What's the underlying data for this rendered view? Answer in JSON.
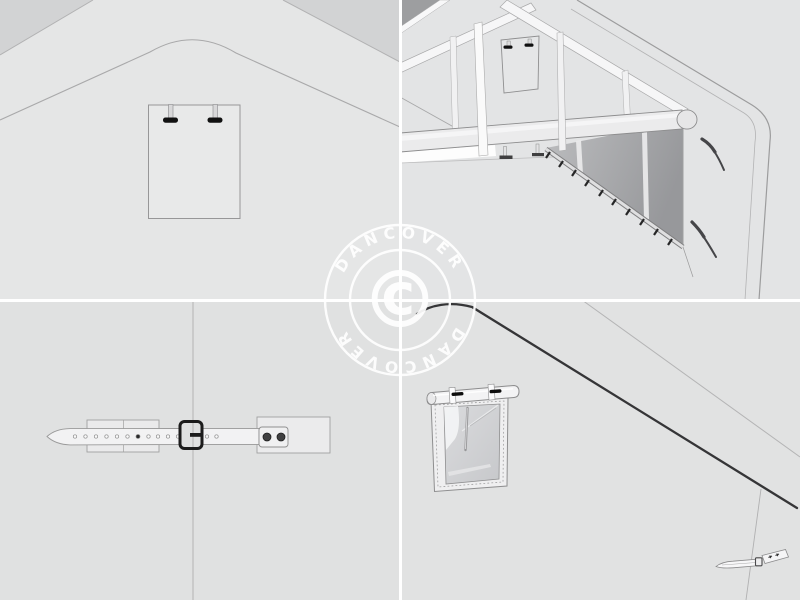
{
  "watermark": {
    "brand_top": "DANCOVER",
    "brand_bottom": "DANCOVER",
    "copyright_symbol": "©",
    "color": "#ffffff"
  },
  "layout": {
    "grid": "2x2 product illustration collage",
    "divider_color": "#ffffff"
  },
  "colors": {
    "background": "#e2e3e3",
    "tent_wall": "#e5e6e6",
    "outside_sky": "#d2d3d4",
    "dark_corner": "#9d9ea0",
    "interior_shadow_light": "#bcbdbf",
    "interior_shadow_dark": "#97989b",
    "outline": "#9b9b9c",
    "hardware_black": "#111111",
    "highlight_white": "#fafafa"
  },
  "panels": [
    {
      "position": "top-left",
      "name": "gable-end-exterior-fastening-plate"
    },
    {
      "position": "top-right",
      "name": "interior-corner-pole-and-roller-rail"
    },
    {
      "position": "bottom-left",
      "name": "strap-and-buckle-closure"
    },
    {
      "position": "bottom-right",
      "name": "rolled-up-window-flap"
    }
  ]
}
